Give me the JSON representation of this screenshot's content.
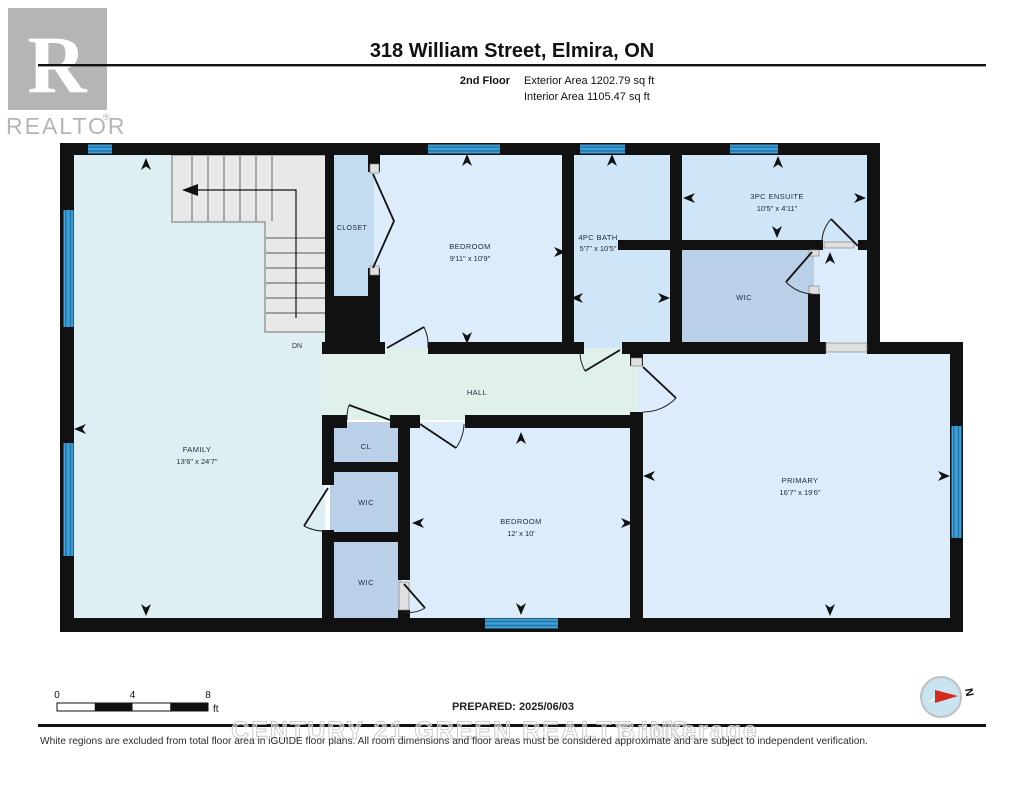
{
  "header": {
    "logo": {
      "r": "R",
      "label": "REALTOR",
      "registered": "®"
    },
    "title": "318 William Street, Elmira, ON",
    "floor_label": "2nd Floor",
    "exterior_area": "Exterior Area 1202.79 sq ft",
    "interior_area": "Interior Area 1105.47 sq ft"
  },
  "plan": {
    "rooms": {
      "closet": {
        "name": "CLOSET"
      },
      "bedroom_top": {
        "name": "BEDROOM",
        "dims": "9'11\" x 10'9\""
      },
      "bath": {
        "name": "4PC BATH",
        "dims": "5'7\" x 10'5\""
      },
      "ensuite": {
        "name": "3PC ENSUITE",
        "dims": "10'5\" x 4'11\""
      },
      "wic_ensuite": {
        "name": "WIC"
      },
      "hall": {
        "name": "HALL"
      },
      "family": {
        "name": "FAMILY",
        "dims": "13'6\" x 24'7\""
      },
      "cl": {
        "name": "CL"
      },
      "wic_mid": {
        "name": "WIC"
      },
      "wic_lower": {
        "name": "WIC"
      },
      "bedroom_bottom": {
        "name": "BEDROOM",
        "dims": "12' x 10'"
      },
      "primary": {
        "name": "PRIMARY",
        "dims": "16'7\" x 19'6\""
      }
    },
    "stairs": {
      "label": "DN"
    },
    "compass": {
      "north": "N"
    }
  },
  "footer": {
    "scale_bar": {
      "ticks": [
        "0",
        "4",
        "8"
      ],
      "unit": "ft"
    },
    "prepared": "PREPARED: 2025/06/03",
    "watermark_1": "CENTURY 21 GREEN REALTY INC.",
    "watermark_2": "Brokerage",
    "disclaimer": "White regions are excluded from total floor area in iGUIDE floor plans. All room dimensions and floor areas must be considered approximate and are subject to independent verification."
  },
  "colors": {
    "wall": "#111111",
    "window_blue": "#3f9ed5",
    "room_blue": "#dcecfa",
    "room_blue_deep": "#cfe6f8",
    "room_gray_blue": "#b9d0e8",
    "family_cyan": "#ddeff3",
    "hall_green": "#e0f1eb",
    "stairs_gray": "#e8e8e8",
    "logo_gray": "#b5b5b5",
    "compass_red": "#d42b1e"
  }
}
